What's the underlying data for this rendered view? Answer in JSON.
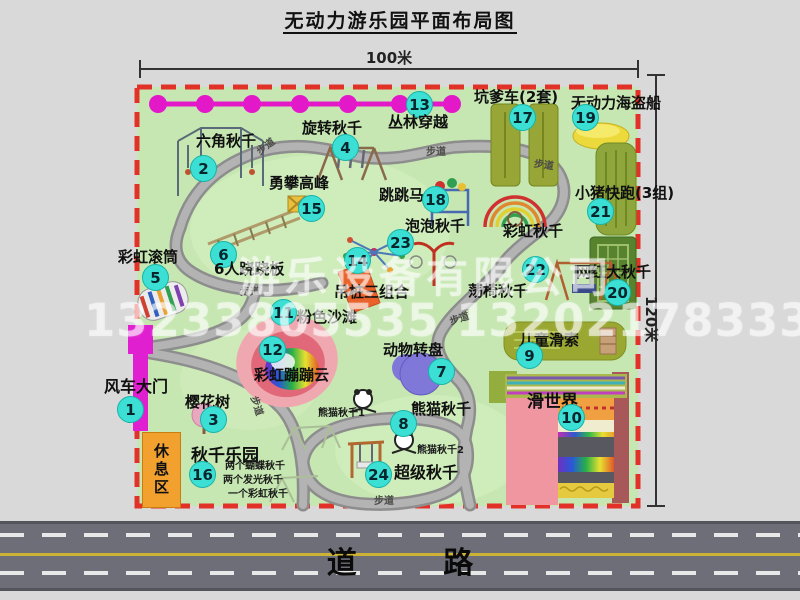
{
  "title": "无动力游乐园平面布局图",
  "dimensions": {
    "width": "100米",
    "height": "120米"
  },
  "watermark": {
    "company": "游乐设备有限公司",
    "phone": "13233805535 13202178333"
  },
  "road": {
    "label": "道 路"
  },
  "park": {
    "path_label": "步道",
    "rest_area": "休息区",
    "attractions": [
      {
        "num": "1",
        "label": "风车大门"
      },
      {
        "num": "2",
        "label": "六角秋千"
      },
      {
        "num": "3",
        "label": "樱花树"
      },
      {
        "num": "4",
        "label": "旋转秋千"
      },
      {
        "num": "5",
        "label": "彩虹滚筒"
      },
      {
        "num": "6",
        "label": "6人跷跷板"
      },
      {
        "num": "7",
        "label": "动物转盘"
      },
      {
        "num": "8",
        "label": "熊猫秋千"
      },
      {
        "num": "9",
        "label": "儿童滑索"
      },
      {
        "num": "10",
        "label": "滑世界"
      },
      {
        "num": "11",
        "label": "粉色沙滩"
      },
      {
        "num": "12",
        "label": "彩虹蹦蹦云"
      },
      {
        "num": "13",
        "label": "丛林穿越"
      },
      {
        "num": "14",
        "label": "吊桩三组合"
      },
      {
        "num": "15",
        "label": "勇攀高峰"
      },
      {
        "num": "16",
        "label": "秋千乐园"
      },
      {
        "num": "17",
        "label": "坑爹车(2套)"
      },
      {
        "num": "18",
        "label": "跳跳马"
      },
      {
        "num": "19",
        "label": "无动力海盗船"
      },
      {
        "num": "20",
        "label": "网红大秋千"
      },
      {
        "num": "21",
        "label": "小猪快跑(3组)"
      },
      {
        "num": "22",
        "label": "荡椅秋千"
      },
      {
        "num": "23",
        "label": "泡泡秋千"
      },
      {
        "num": "24",
        "label": "超级秋千"
      }
    ],
    "extra": {
      "rainbow_swing": "彩虹秋千",
      "panda_swing_1": "熊猫秋千1",
      "panda_swing_2": "熊猫秋千2",
      "swing_note_1": "两个蝴蝶秋千",
      "swing_note_2": "两个发光秋千",
      "swing_note_3": "一个彩虹秋千"
    }
  }
}
